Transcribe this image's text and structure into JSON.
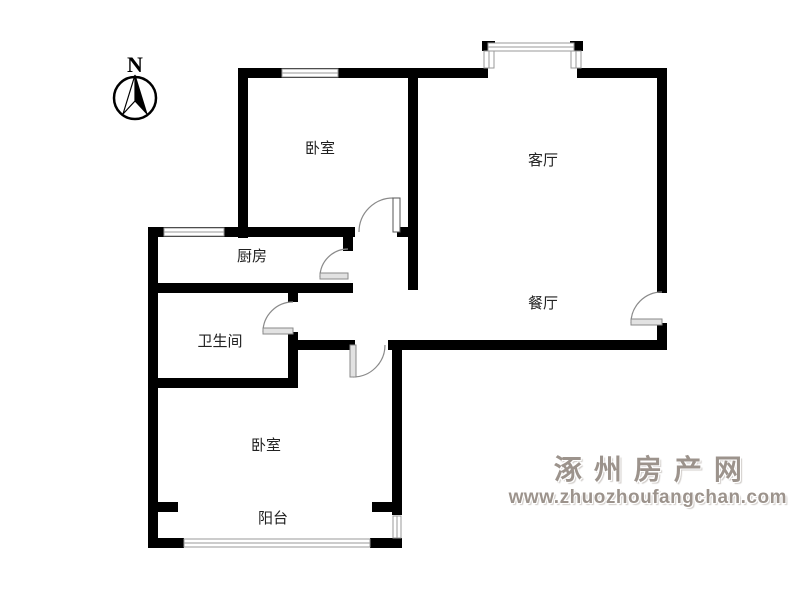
{
  "compass": {
    "north_label": "N"
  },
  "rooms": {
    "bedroom_top": "卧室",
    "living_room": "客厅",
    "kitchen": "厨房",
    "bathroom": "卫生间",
    "dining_room": "餐厅",
    "bedroom_bottom": "卧室",
    "balcony": "阳台"
  },
  "watermark": {
    "site_name": "涿州房产网",
    "site_url": "www.zhuozhoufangchan.com"
  },
  "colors": {
    "wall": "#000000",
    "window_line": "#9a9a9a",
    "door_symbol": "#8a8a8a",
    "room_label": "#222222",
    "watermark_text": "#9c938c",
    "background": "#ffffff"
  }
}
